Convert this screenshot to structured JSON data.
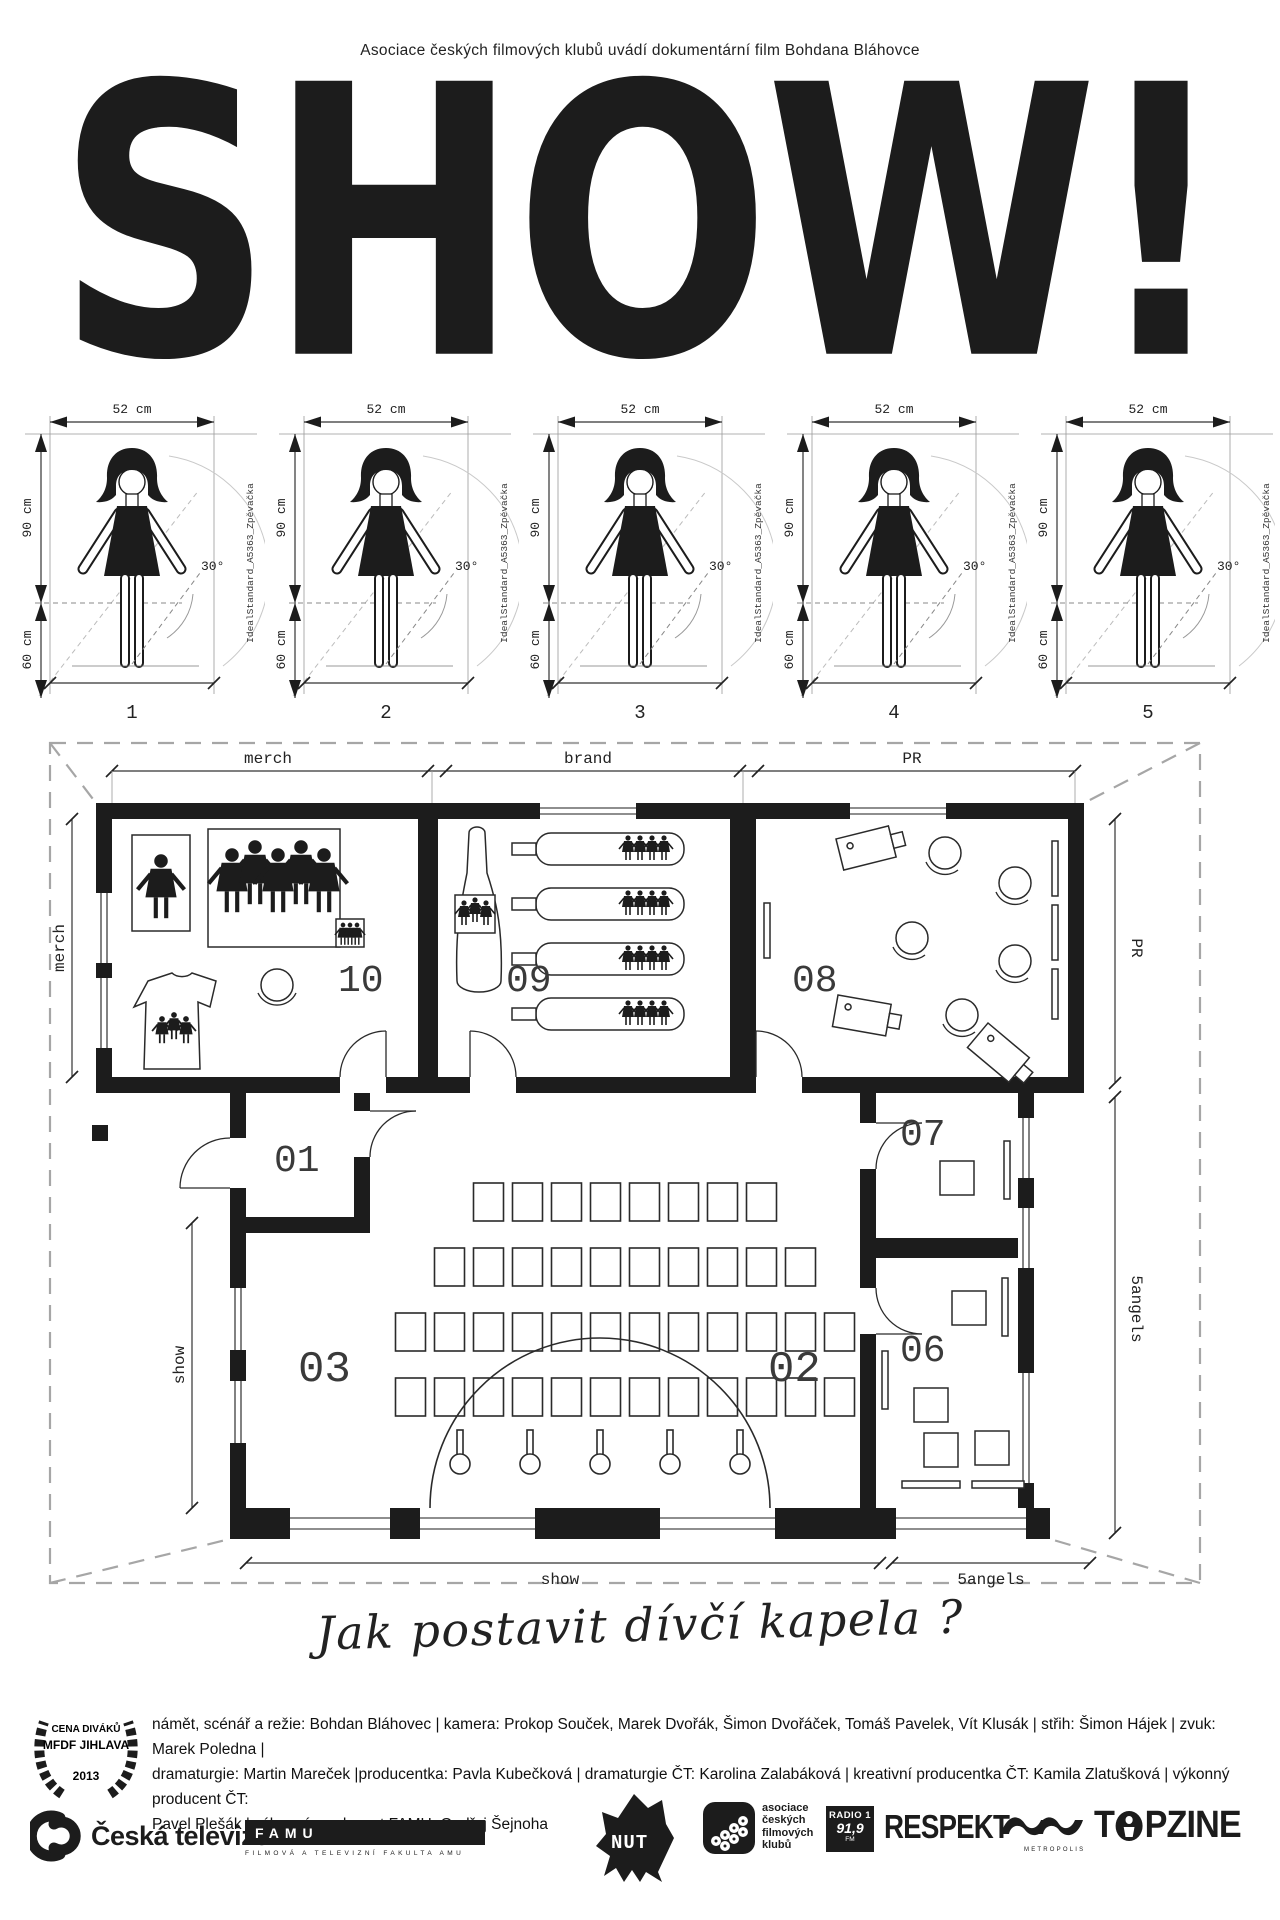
{
  "colors": {
    "ink": "#1c1c1c",
    "paper": "#ffffff"
  },
  "header": {
    "presenter_line": "Asociace českých filmových klubů uvádí dokumentární film Bohdana Bláhovce",
    "title": "SHOW!"
  },
  "figure_diagrams": {
    "width_label": "52 cm",
    "upper_height_label": "90 cm",
    "lower_height_label": "60 cm",
    "angle_label": "30°",
    "side_label": "IdealStandard_A5363_Zpěvačka",
    "numbers": [
      "1",
      "2",
      "3",
      "4",
      "5"
    ]
  },
  "floorplan": {
    "top_dims": [
      "merch",
      "brand",
      "PR"
    ],
    "left_dims": [
      "merch",
      "show"
    ],
    "right_dims": [
      "PR",
      "5angels"
    ],
    "bottom_dims": [
      "show",
      "5angels"
    ],
    "rooms": {
      "r01": "01",
      "r02": "02",
      "r03": "03",
      "r06": "06",
      "r07": "07",
      "r08": "08",
      "r09": "09",
      "r10": "10"
    },
    "hall_chair_rows": [
      8,
      10,
      12,
      12
    ],
    "stage_mic_count": 5
  },
  "tagline": "Jak postavit dívčí kapela ?",
  "award": {
    "line1": "CENA DIVÁKŮ",
    "line2": "MFDF JIHLAVA",
    "line3": "2013"
  },
  "credits": {
    "lines": [
      "námět, scénář a režie: Bohdan Bláhovec | kamera: Prokop Souček, Marek Dvořák, Šimon Dvořáček, Tomáš Pavelek, Vít Klusák | střih: Šimon Hájek | zvuk: Marek Poledna |",
      "dramaturgie: Martin Mareček |producentka: Pavla Kubečková | dramaturgie ČT: Karolina Zalabáková | kreativní producentka ČT: Kamila Zlatušková | výkonný producent ČT:",
      "Pavel Plešák | výkonný producent FAMU: Ondřej Šejnoha"
    ]
  },
  "logos": {
    "ceska_televize": "Česká televize",
    "famu": "FAMU",
    "famu_sub": "FILMOVÁ A TELEVIZNÍ FAKULTA AMU",
    "nut": "NUT",
    "acfk_lines": [
      "asociace",
      "českých",
      "filmových",
      "klubů"
    ],
    "radio": {
      "name": "RADIO 1",
      "freq": "91,9",
      "band": "FM"
    },
    "respekt": "RESPEKT",
    "metropolis": "METROPOLIS",
    "topzine": {
      "left": "T",
      "right": "PZINE"
    }
  }
}
